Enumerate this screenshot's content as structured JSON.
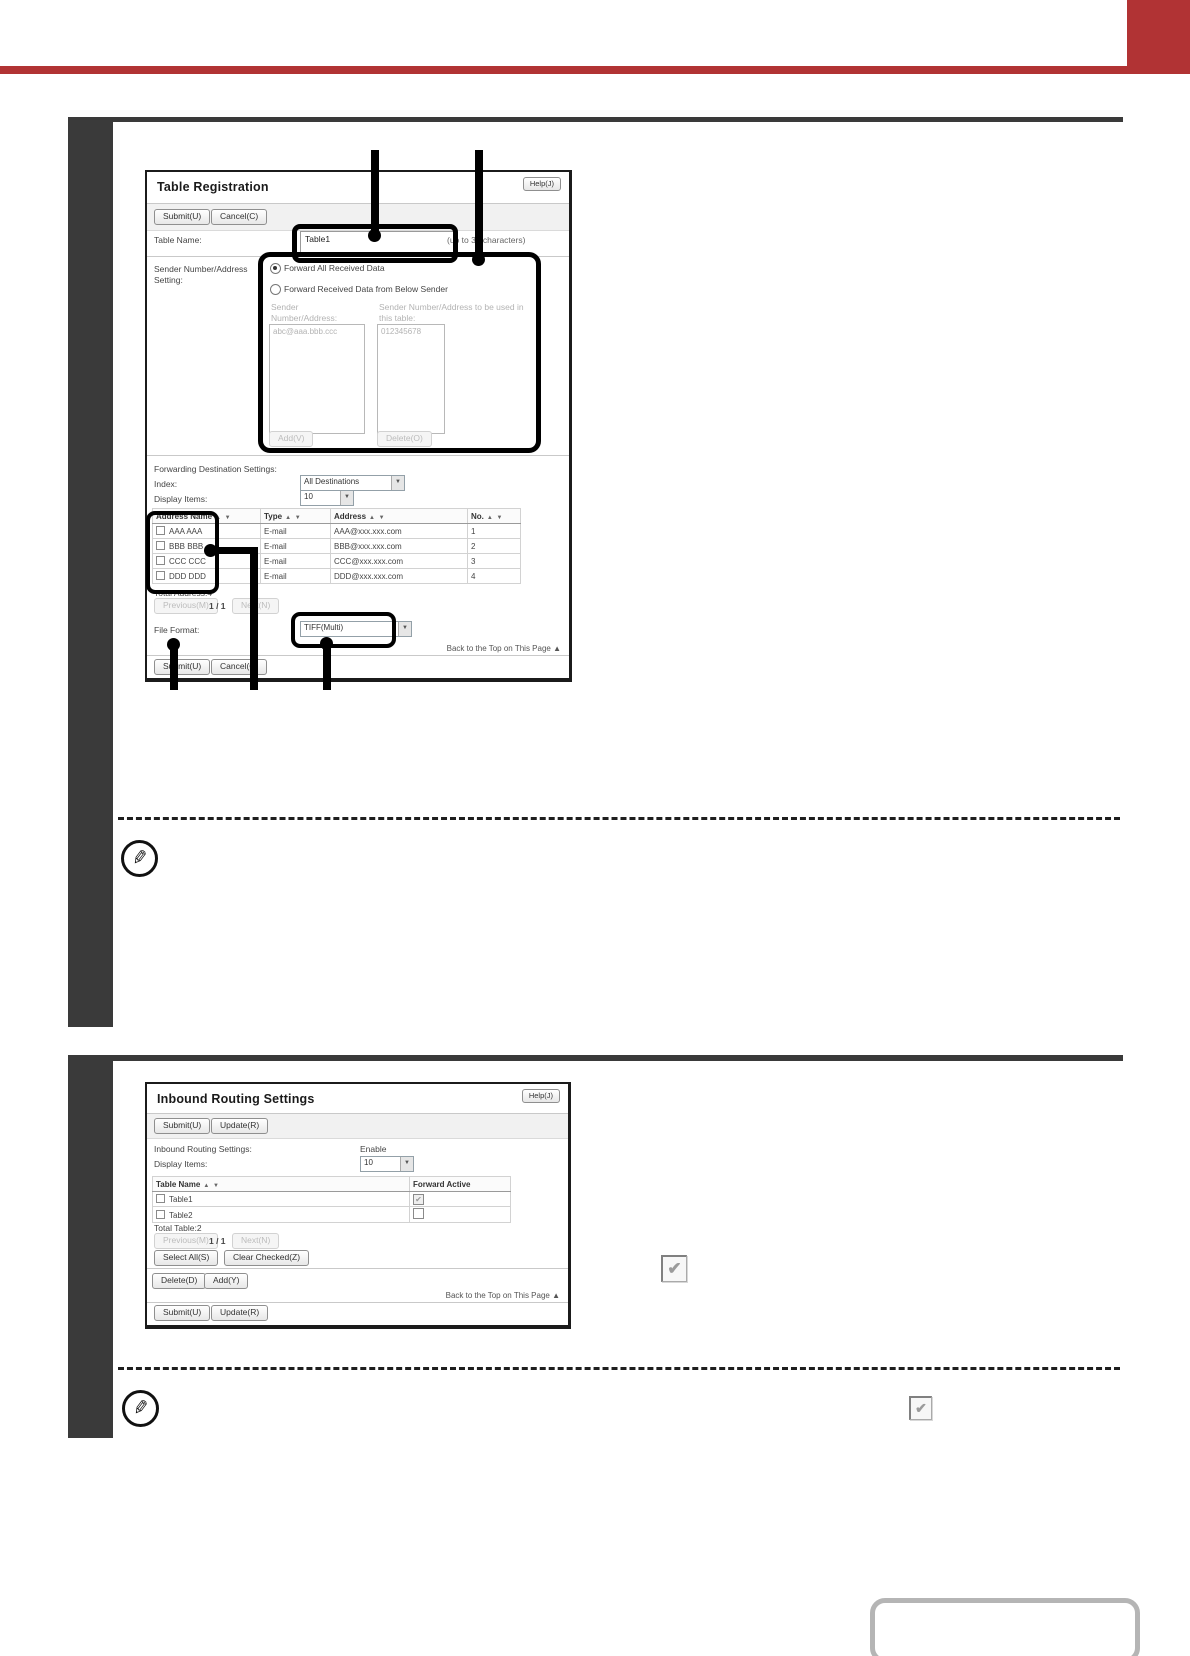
{
  "colors": {
    "accent_red": "#b13334",
    "bar_dark": "#3a3a3a"
  },
  "icons": {
    "dropdown_arrow": "▼",
    "sort_asc": "▲",
    "sort_desc": "▼",
    "back_top_arrow": "▲",
    "pencil": "✎",
    "check": "✔"
  },
  "s1": {
    "title": "Table Registration",
    "help": "Help(J)",
    "submit": "Submit(U)",
    "cancel": "Cancel(C)",
    "table_name_label": "Table Name:",
    "table_name_value": "Table1",
    "table_name_hint": "(up to 36 characters)",
    "sender_label": "Sender Number/Address Setting:",
    "radio_forward_all": "Forward All Received Data",
    "radio_forward_below": "Forward Received Data from Below Sender",
    "sender_list_label": "Sender Number/Address:",
    "sender_list_value": "abc@aaa.bbb.ccc",
    "sender_used_label": "Sender Number/Address to be used in this table:",
    "sender_used_value": "012345678",
    "add": "Add(V)",
    "delete": "Delete(O)",
    "fwd_section": "Forwarding Destination Settings:",
    "index_label": "Index:",
    "index_value": "All Destinations",
    "display_label": "Display Items:",
    "display_value": "10",
    "col_name": "Address Name",
    "col_type": "Type",
    "col_address": "Address",
    "col_no": "No.",
    "rows": [
      {
        "name": "AAA AAA",
        "type": "E-mail",
        "address": "AAA@xxx.xxx.com",
        "no": "1"
      },
      {
        "name": "BBB BBB",
        "type": "E-mail",
        "address": "BBB@xxx.xxx.com",
        "no": "2"
      },
      {
        "name": "CCC CCC",
        "type": "E-mail",
        "address": "CCC@xxx.xxx.com",
        "no": "3"
      },
      {
        "name": "DDD DDD",
        "type": "E-mail",
        "address": "DDD@xxx.xxx.com",
        "no": "4"
      }
    ],
    "total": "Total Address:4",
    "previous": "Previous(M)",
    "page": "1 / 1",
    "next": "Next(N)",
    "file_format_label": "File Format:",
    "file_format_value": "TIFF(Multi)",
    "back_top": "Back to the Top on This Page"
  },
  "s2": {
    "title": "Inbound Routing Settings",
    "help": "Help(J)",
    "submit": "Submit(U)",
    "update": "Update(R)",
    "settings_label": "Inbound Routing Settings:",
    "settings_value": "Enable",
    "display_label": "Display Items:",
    "display_value": "10",
    "col_table_name": "Table Name",
    "col_forward_active": "Forward Active",
    "rows": [
      {
        "name": "Table1",
        "active": "checked"
      },
      {
        "name": "Table2",
        "active": "unchecked"
      }
    ],
    "total": "Total Table:2",
    "previous": "Previous(M)",
    "page": "1 / 1",
    "next": "Next(N)",
    "select_all": "Select All(S)",
    "clear_checked": "Clear Checked(Z)",
    "delete": "Delete(D)",
    "add": "Add(Y)",
    "back_top": "Back to the Top on This Page"
  }
}
